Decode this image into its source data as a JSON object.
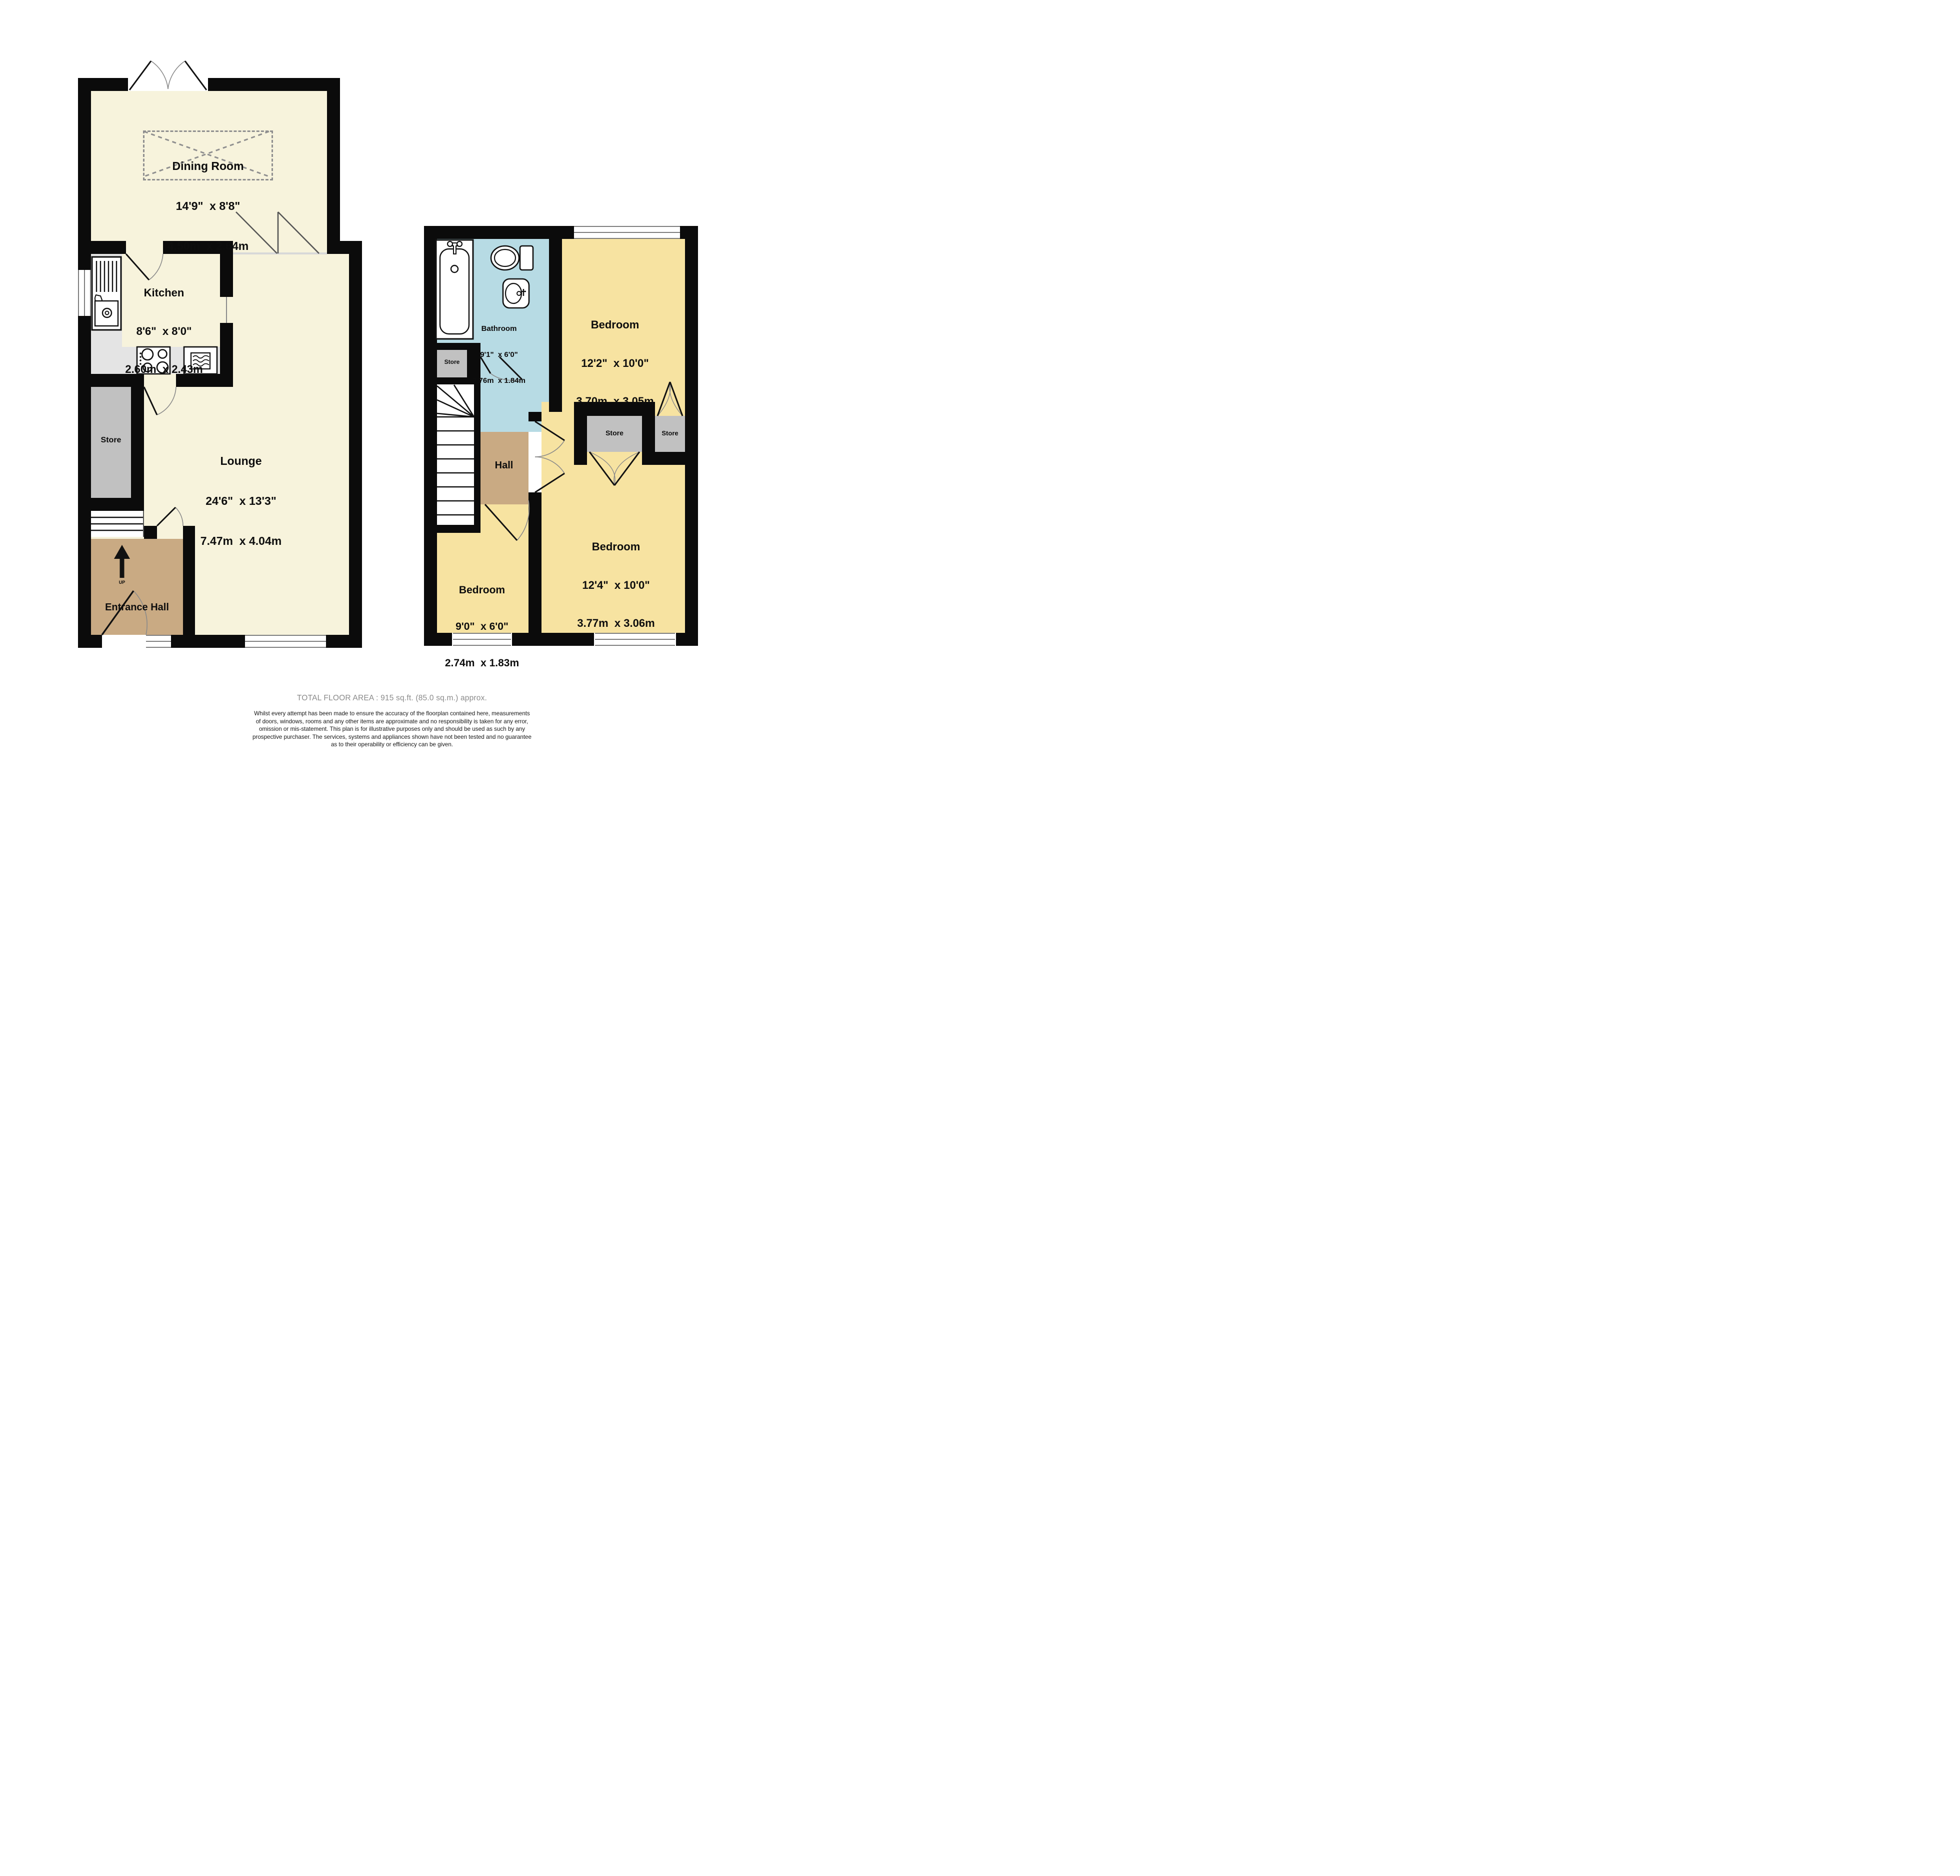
{
  "colors": {
    "wall": "#0b0b0b",
    "cream_room": "#f7f3dc",
    "yellow_room": "#f7e3a1",
    "blue_room": "#b7dbe4",
    "tan_room": "#c9aa83",
    "store_grey": "#c1c1c1",
    "counter_grey": "#e4e4e4",
    "footer_title_grey": "#8a8a8a"
  },
  "ground_floor": {
    "rooms": {
      "dining": {
        "name": "Dining Room",
        "imperial": "14'9\"  x 8'8\"",
        "metric": "4.50m  x 2.64m"
      },
      "kitchen": {
        "name": "Kitchen",
        "imperial": "8'6\"  x 8'0\"",
        "metric": "2.60m  x 2.43m"
      },
      "lounge": {
        "name": "Lounge",
        "imperial": "24'6\"  x 13'3\"",
        "metric": "7.47m  x 4.04m"
      },
      "store": {
        "name": "Store"
      },
      "entrance_hall": {
        "name": "Entrance Hall"
      },
      "stairs_up_label": "UP"
    }
  },
  "first_floor": {
    "rooms": {
      "bathroom": {
        "name": "Bathroom",
        "imperial": "9'1\"  x 6'0\"",
        "metric": "2.76m  x 1.84m"
      },
      "bedroom_top": {
        "name": "Bedroom",
        "imperial": "12'2\"  x 10'0\"",
        "metric": "3.70m  x 3.05m"
      },
      "bedroom_bottom_right": {
        "name": "Bedroom",
        "imperial": "12'4\"  x 10'0\"",
        "metric": "3.77m  x 3.06m"
      },
      "bedroom_bottom_left": {
        "name": "Bedroom",
        "imperial": "9'0\"  x 6'0\"",
        "metric": "2.74m  x 1.83m"
      },
      "store_landing": {
        "name": "Store"
      },
      "store_closet_left": {
        "name": "Store"
      },
      "store_closet_right": {
        "name": "Store"
      },
      "hall": {
        "name": "Hall"
      }
    }
  },
  "footer": {
    "total_area": "TOTAL FLOOR AREA : 915 sq.ft. (85.0 sq.m.) approx.",
    "disclaimer_lines": [
      "Whilst every attempt has been made to ensure the accuracy of the floorplan contained here, measurements",
      "of doors, windows, rooms and any other items are approximate and no responsibility is taken for any error,",
      "omission or mis-statement. This plan is for illustrative purposes only and should be used as such by any",
      "prospective purchaser. The services, systems and appliances shown have not been tested and no guarantee",
      "as to their operability or efficiency can be given."
    ],
    "credit": "Made with Metropix ©2025"
  }
}
